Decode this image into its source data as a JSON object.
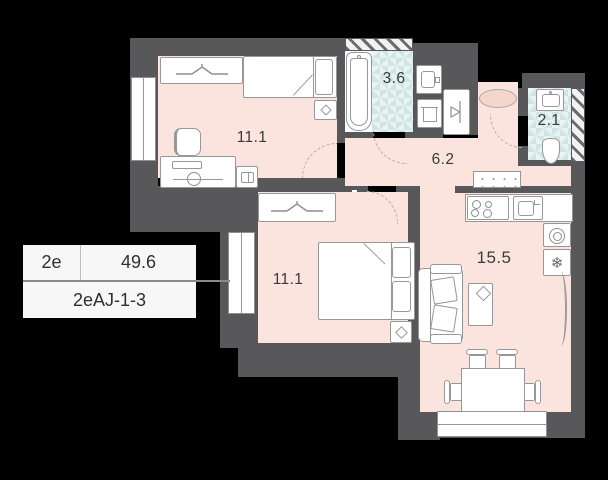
{
  "plan_card": {
    "flat_type": "2e",
    "area_total": "49.6",
    "plan_code": "2eAJ-1-3"
  },
  "rooms": [
    {
      "id": "bedroom-top",
      "area_label": "11.1"
    },
    {
      "id": "bathroom",
      "area_label": "3.6"
    },
    {
      "id": "hallway",
      "area_label": "6.2"
    },
    {
      "id": "wc",
      "area_label": "2.1"
    },
    {
      "id": "bedroom-left",
      "area_label": "11.1"
    },
    {
      "id": "living-kitchen",
      "area_label": "15.5"
    }
  ],
  "glyphs": {
    "snowflake": "❄"
  },
  "icons": [
    "hanger-icon",
    "desk-lamp-icon",
    "book-icon",
    "coat-hook-icon",
    "snowflake-icon",
    "hob-burners-icon",
    "sink-icon",
    "bathtub-icon",
    "toilet-icon",
    "washing-machine-drum-icon"
  ],
  "colors": {
    "background": "#000000",
    "wall": "#58585A",
    "floor": "#FBE4DD",
    "wet_room_tile": "#CFE6E4",
    "furniture_outline": "#97979A",
    "label_text": "#3A3A3C",
    "card_background": "#F7F7F7"
  }
}
